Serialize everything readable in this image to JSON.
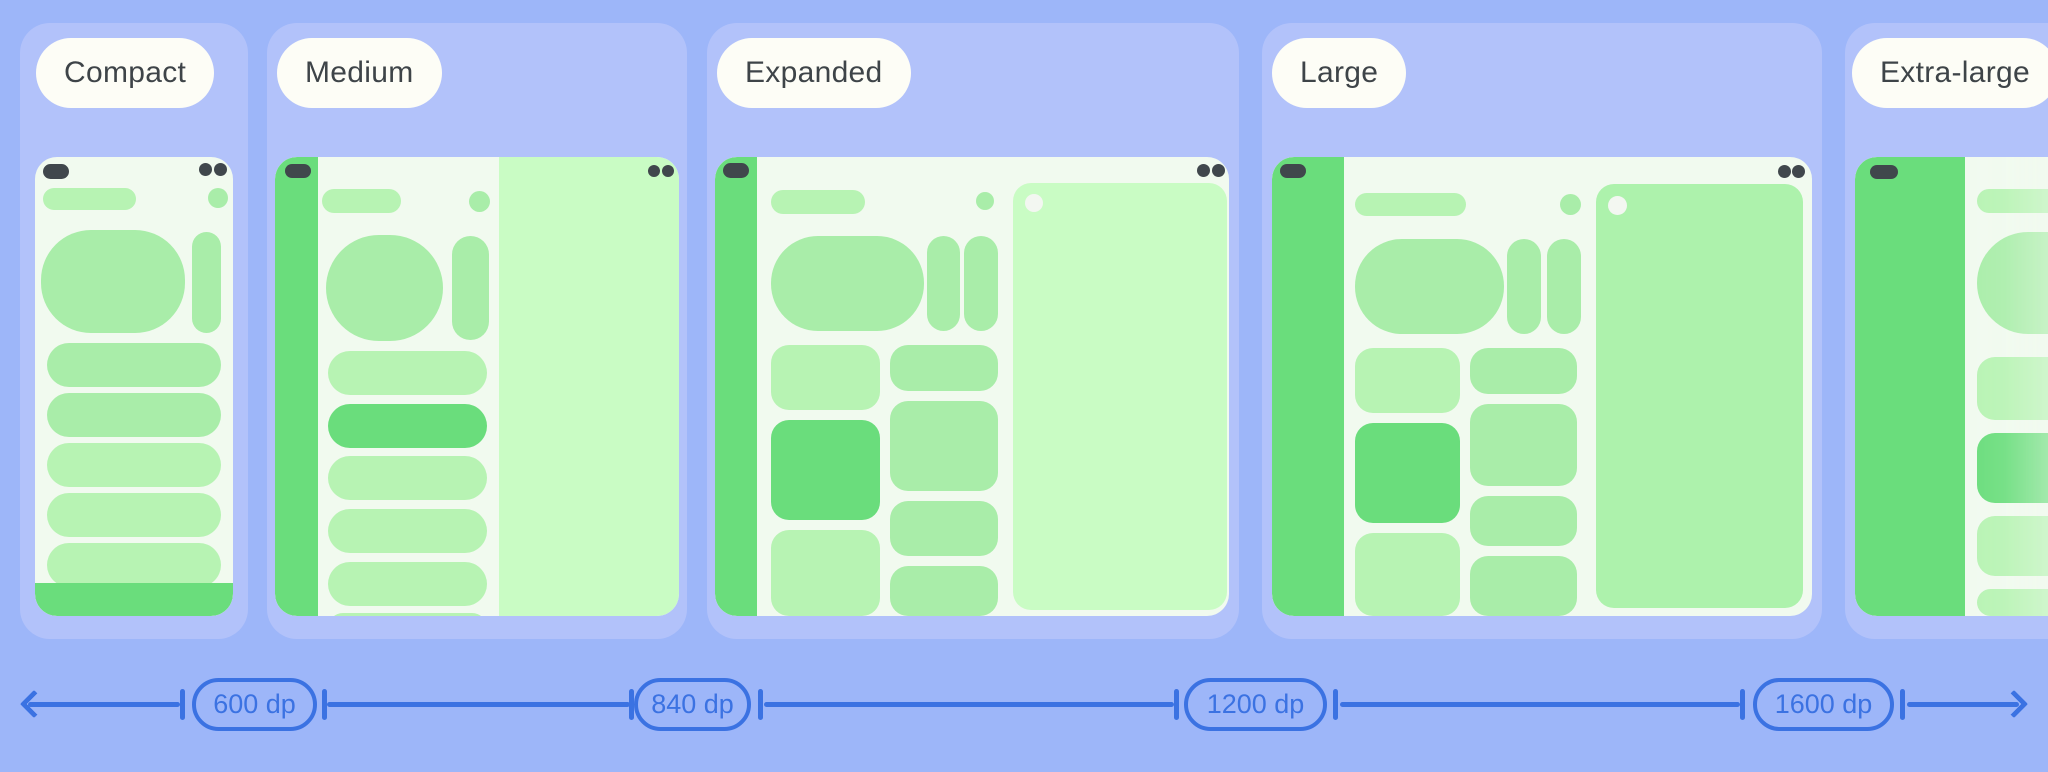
{
  "cards": [
    {
      "id": "compact",
      "label": "Compact"
    },
    {
      "id": "medium",
      "label": "Medium"
    },
    {
      "id": "expanded",
      "label": "Expanded"
    },
    {
      "id": "large",
      "label": "Large"
    },
    {
      "id": "extra-large",
      "label": "Extra-large"
    }
  ],
  "ruler": {
    "breakpoints": [
      {
        "label": "600 dp"
      },
      {
        "label": "840 dp"
      },
      {
        "label": "1200 dp"
      },
      {
        "label": "1600 dp"
      }
    ],
    "icons": {
      "left": "arrow-left",
      "right": "arrow-right"
    }
  },
  "colors": {
    "page_bg": "#9db6f9",
    "card_bg": "#b2c2fa",
    "label_pill_bg": "#fdfdf6",
    "label_text": "#3e4448",
    "window_bg": "#f1faef",
    "green_strong": "#6add7c",
    "green_mid": "#a9eda9",
    "green_soft": "#b7f3b3",
    "detail_pane_light": "#c9fcc4",
    "detail_pane_medium": "#adf2ac",
    "dark_accent": "#40474c",
    "ruler_blue": "#3b72e2"
  }
}
